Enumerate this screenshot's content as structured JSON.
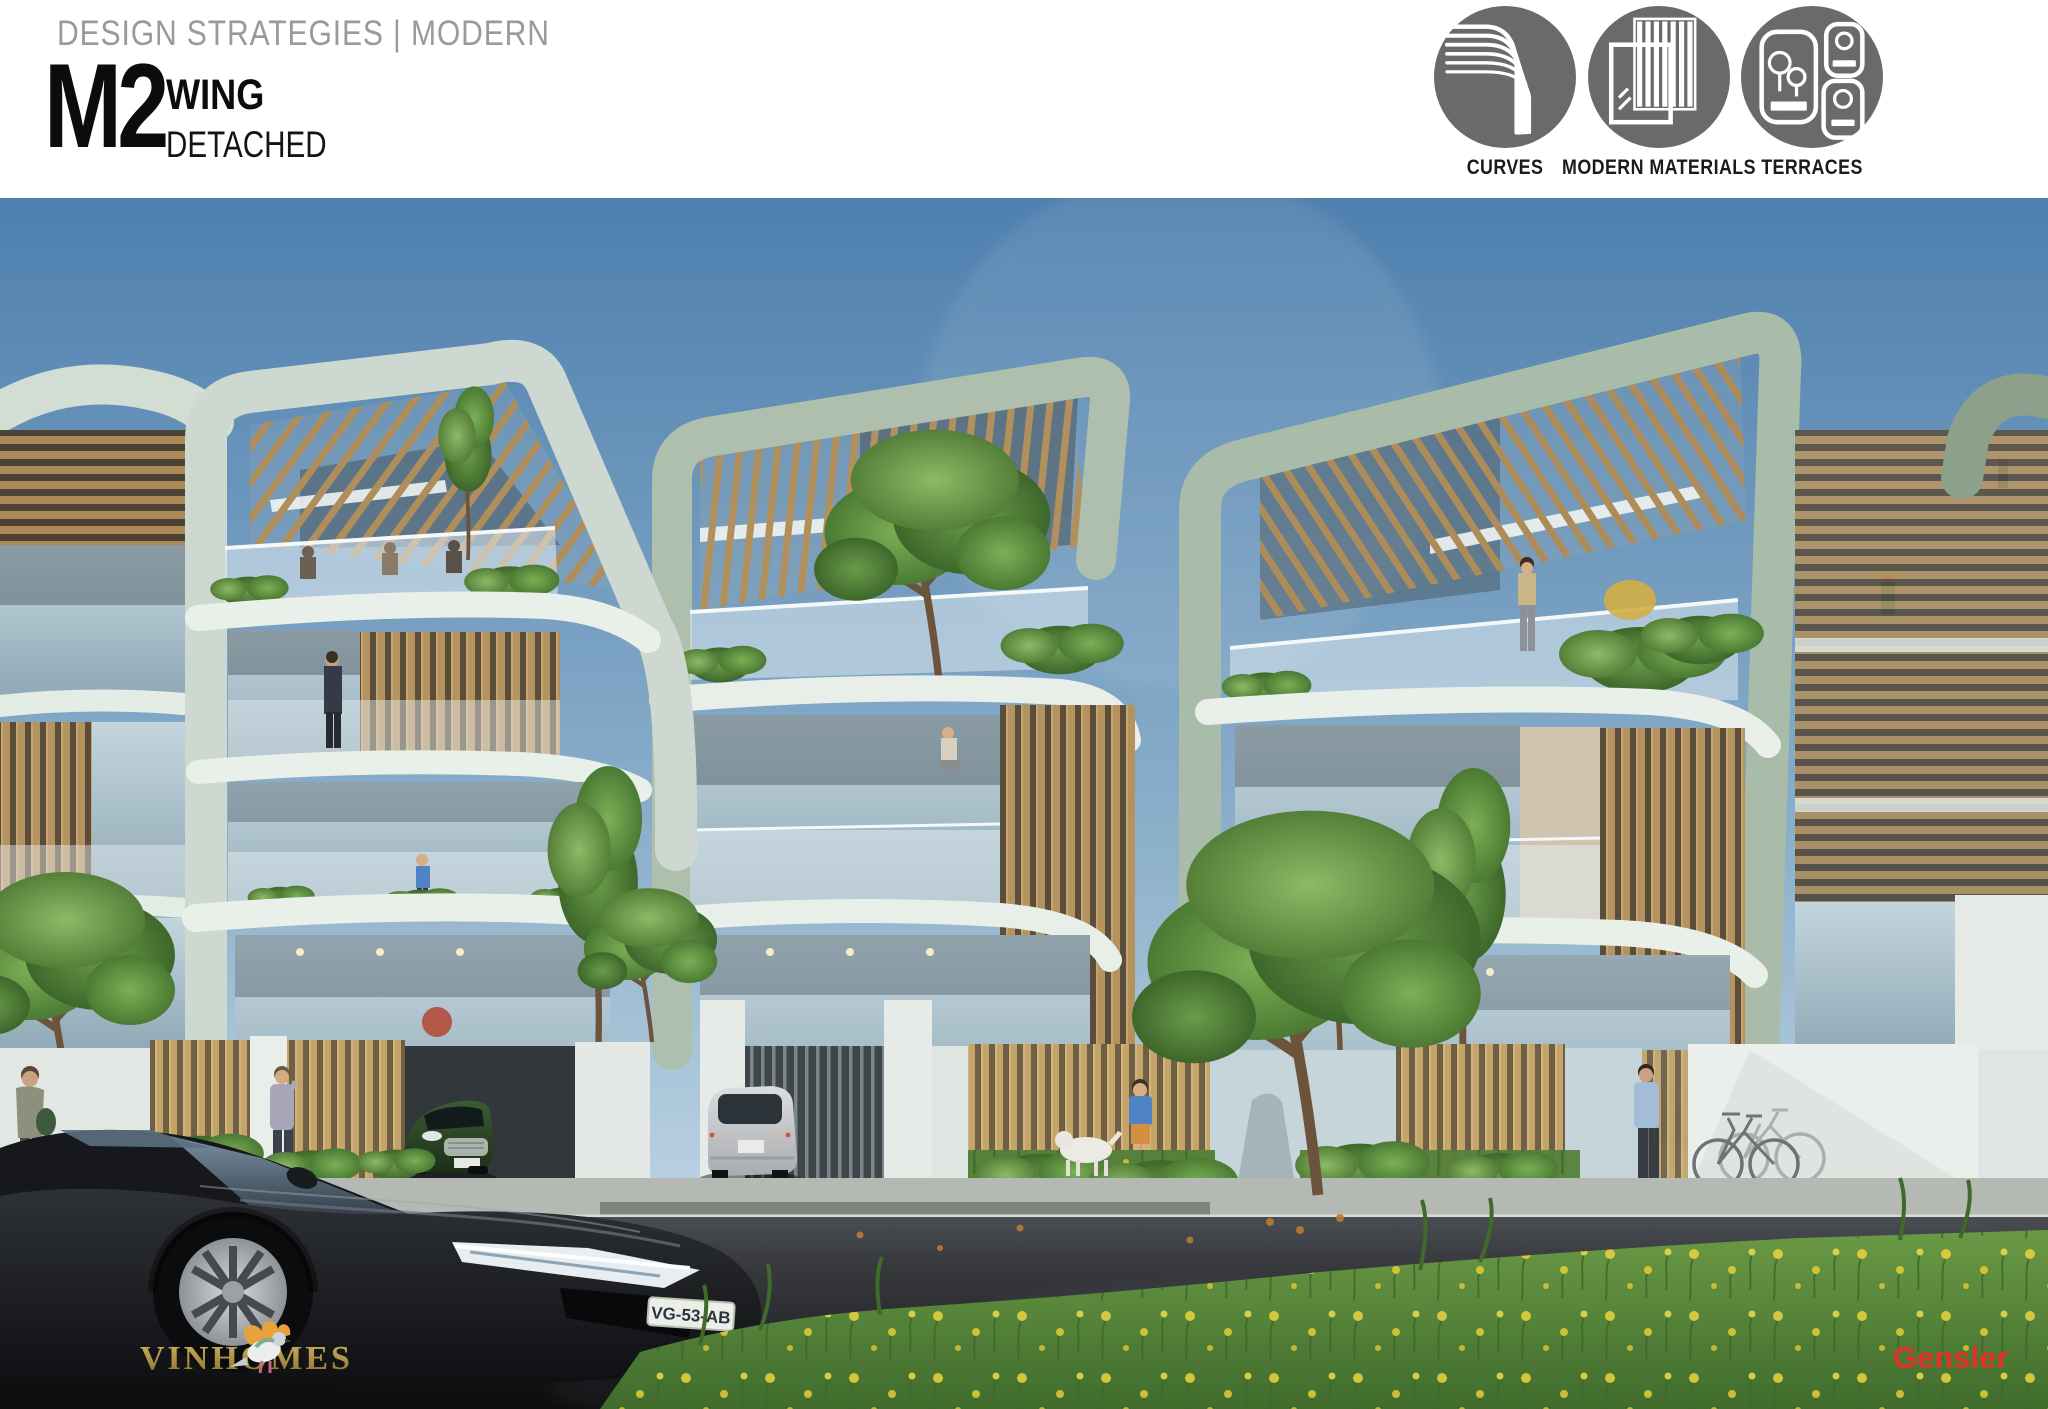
{
  "header": {
    "eyebrow": "DESIGN STRATEGIES | MODERN",
    "code": "M2",
    "title": "WING",
    "subtitle": "DETACHED"
  },
  "strategies": [
    {
      "label": "CURVES"
    },
    {
      "label": "MODERN MATERIALS"
    },
    {
      "label": "TERRACES"
    }
  ],
  "scene": {
    "license_plate": "VG-53-AB",
    "logos": {
      "developer": "VINHOMES",
      "architect": "Gensler"
    },
    "colors": {
      "sky_top": "#4e7fae",
      "sky_horizon": "#d6e6ef",
      "canopy_light": "#cdd9d0",
      "canopy_sage": "#a9bba9",
      "canopy_dark": "#8ca08c",
      "wood_slat": "#b5935e",
      "glass": "#a9c0cd",
      "slab_white": "#e9f0ea",
      "fence_blue": "#c6d5da",
      "road": "#26282c",
      "grass": "#55813a",
      "flower_yellow": "#ecd23e",
      "brand_gold": "#c9a544",
      "brand_red": "#e23227",
      "icon_circle_gray": "#696b69"
    }
  }
}
